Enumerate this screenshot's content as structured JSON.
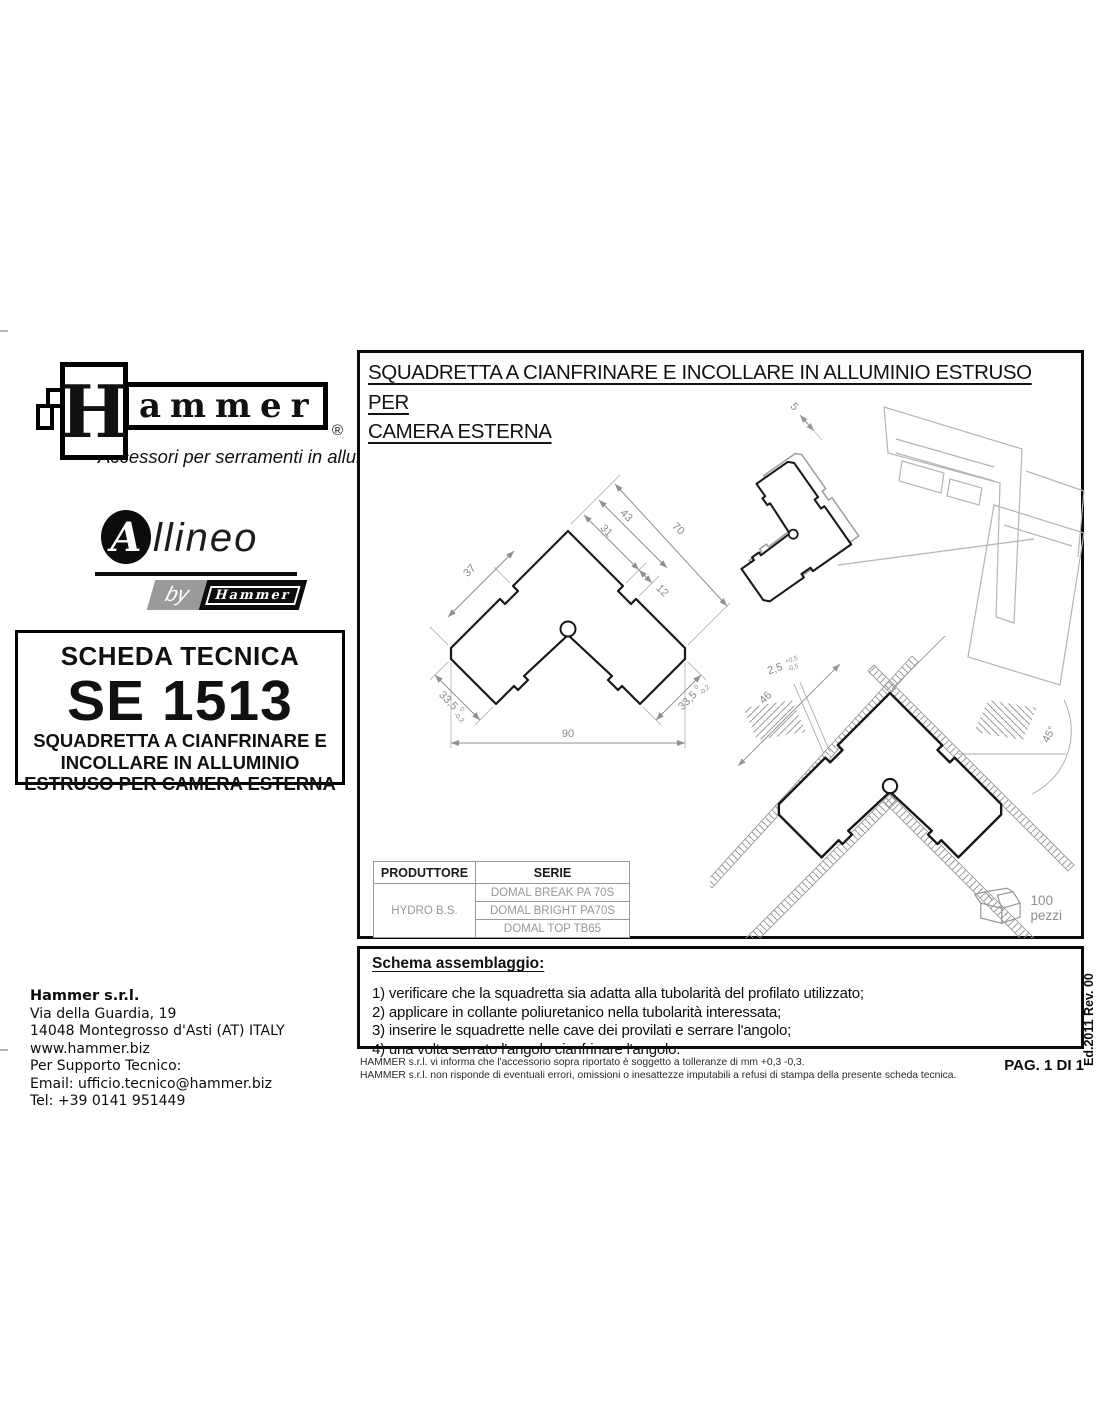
{
  "branding": {
    "hammer_h": "H",
    "hammer_rest": "ammer",
    "registered": "®",
    "tagline": "Accessori per serramenti in alluminio",
    "allineo_a": "A",
    "allineo_rest": "llineo",
    "by": "by",
    "by_hammer": "Hammer"
  },
  "sheet": {
    "label": "SCHEDA TECNICA",
    "code": "SE 1513",
    "desc1": "SQUADRETTA A CIANFRINARE E",
    "desc2": "INCOLLARE IN ALLUMINIO",
    "desc3": "ESTRUSO PER CAMERA ESTERNA"
  },
  "drawing": {
    "title1": "SQUADRETTA A CIANFRINARE E INCOLLARE  IN ALLUMINIO ESTRUSO PER",
    "title2": "CAMERA ESTERNA",
    "quantity": "100 pezzi",
    "dims": {
      "d37": "37",
      "d43": "43",
      "d31": "31",
      "d12": "12",
      "d70": "70",
      "d90": "90",
      "d335": "33,5",
      "tol_hi": "0",
      "tol_lo": "-0,2",
      "d5": "5",
      "d46": "46",
      "d25": "2,5",
      "tol25_hi": "+0,5",
      "tol25_lo": "-0,5",
      "angle": "45°"
    }
  },
  "table": {
    "col1": "PRODUTTORE",
    "col2": "SERIE",
    "producer": "HYDRO B.S.",
    "serie1": "DOMAL BREAK PA 70S",
    "serie2": "DOMAL BRIGHT PA70S",
    "serie3": "DOMAL TOP TB65"
  },
  "assembly": {
    "heading": "Schema assemblaggio:",
    "step1": "1) verificare che la squadretta sia adatta alla tubolarità del profilato utilizzato;",
    "step2": "2) applicare in collante poliuretanico nella tubolarità interessata;",
    "step3": "3) inserire le squadrette nelle cave dei provilati e serrare l'angolo;",
    "step4": "4) una volta serrato l'angolo cianfrinare l'angolo."
  },
  "contact": {
    "company": "Hammer s.r.l.",
    "line1": "Via della Guardia, 19",
    "line2": "14048 Montegrosso d'Asti (AT) ITALY",
    "line3": "www.hammer.biz",
    "line4": "Per Supporto Tecnico:",
    "line5": "Email: ufficio.tecnico@hammer.biz",
    "line6": "Tel: +39 0141 951449"
  },
  "footer": {
    "note1": "HAMMER s.r.l. vi informa che l'accessorio sopra riportato è soggetto a tolleranze di mm +0,3 -0,3.",
    "note2": "HAMMER s.r.l. non risponde di eventuali errori, omissioni o inesattezze imputabili a refusi di stampa della presente scheda tecnica.",
    "page": "PAG. 1 DI 1",
    "edition": "Ed.2011 Rev. 00"
  },
  "colors": {
    "ink": "#111111",
    "dim_gray": "#8f8f8f",
    "profile_gray": "#b5b5b5",
    "table_text_gray": "#979797"
  }
}
